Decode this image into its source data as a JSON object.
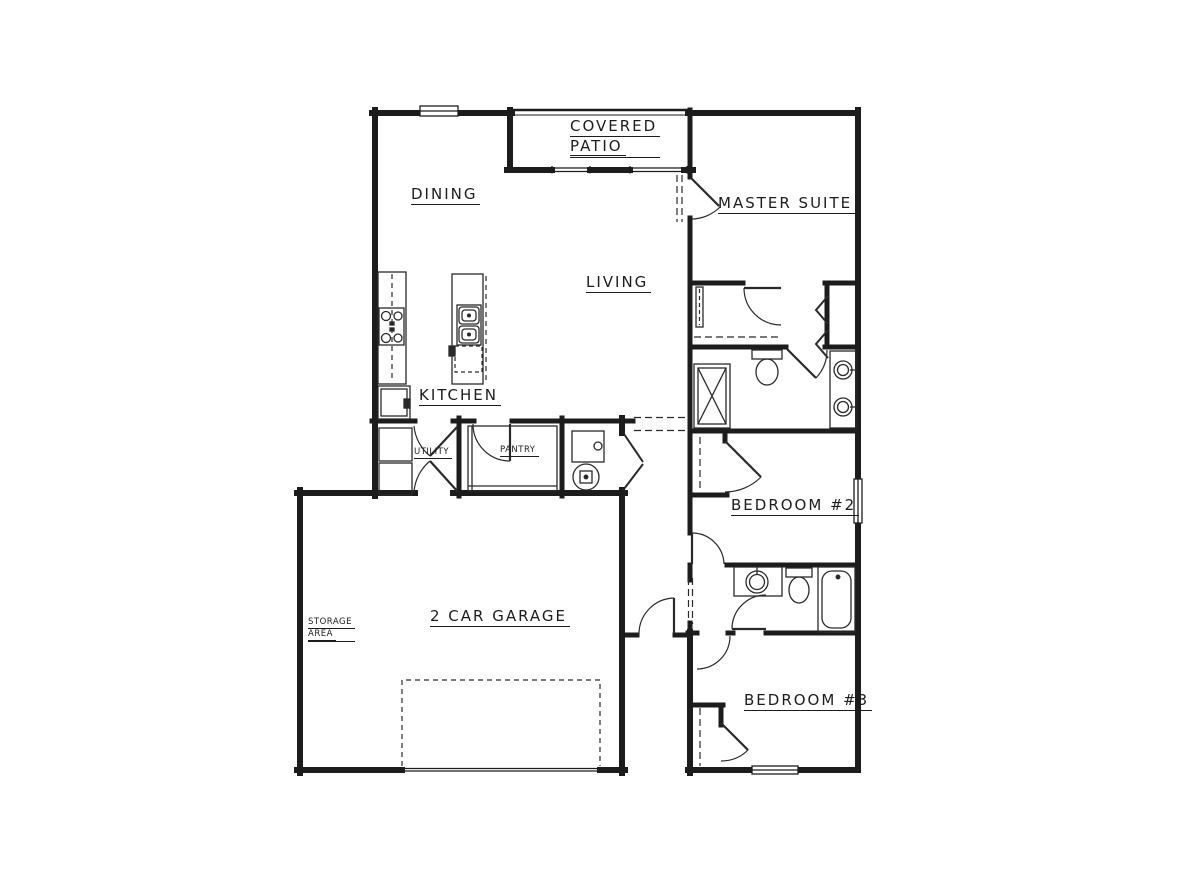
{
  "document": {
    "title": "Residential Floor Plan",
    "drawing_type": "single-story house floor plan"
  },
  "rooms": {
    "covered_patio_line1": "COVERED",
    "covered_patio_line2": "PATIO",
    "dining": "DINING",
    "master_suite": "MASTER SUITE",
    "living": "LIVING",
    "kitchen": "KITCHEN",
    "utility": "UTILITY",
    "pantry": "PANTRY",
    "bedroom_2": "BEDROOM #2",
    "garage": "2 CAR GARAGE",
    "storage_line1": "STORAGE",
    "storage_line2": "AREA",
    "bedroom_3": "BEDROOM #3"
  },
  "colors": {
    "line": "#1c1c1c",
    "background": "#ffffff"
  },
  "fixtures": [
    "range-cooktop",
    "refrigerator",
    "island-double-sink",
    "dishwasher",
    "washer",
    "dryer",
    "furnace",
    "water-heater",
    "shower",
    "toilet",
    "double-vanity-sinks",
    "vanity-sink",
    "bathtub",
    "closet-rods",
    "garage-overhead-door"
  ]
}
